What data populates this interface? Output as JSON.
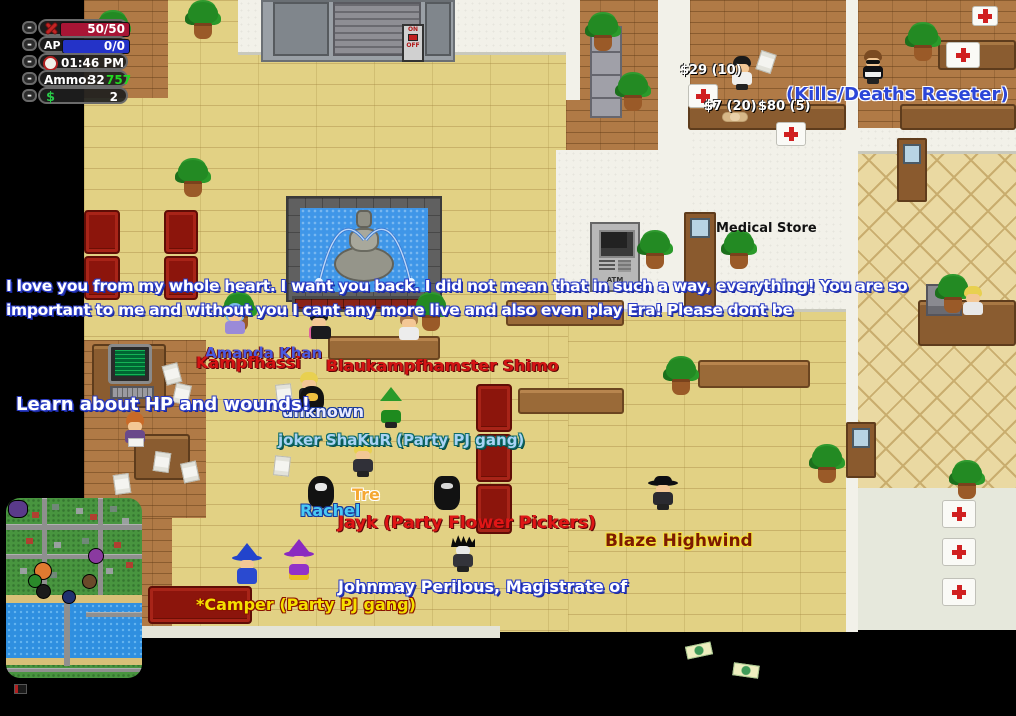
{
  "hud": {
    "minimize": "-",
    "health_value": "50/50",
    "ap_label": "AP",
    "ap_value": "0/0",
    "time": "01:46 PM",
    "ammo_label": "Ammo:",
    "ammo_value": "32",
    "ammo_extra": "757",
    "money_symbol": "$",
    "money_value": "2",
    "colors": {
      "health_bar": "#a81535",
      "ap_bar": "#2433c8",
      "ammo_extra": "#22d822",
      "money": "#28c848"
    }
  },
  "chat": {
    "line1": "I love you from my whole heart. I want you back. I did not mean that in such a way, everything! You are so",
    "line2": "important to me and without you I cant any more live and also even play Era! Please dont be",
    "hint": "Learn about HP and wounds!"
  },
  "world": {
    "medical_sign": "Medical Store",
    "npc_title": "(Kills/Deaths Reseter)",
    "npc_title_color": "#2c46d8",
    "price_medkit_small": "$29 (10)",
    "price_bandage": "$7 (20)",
    "price_medkit_large": "$80 (5)",
    "atm_label": "ATM",
    "switch_on": "ON",
    "switch_off": "OFF"
  },
  "players": [
    {
      "name": "Amanda Khan",
      "color": "#4a5ae0"
    },
    {
      "name": "Kampfhassi",
      "color": "#d41414"
    },
    {
      "name": "Blaukampfhamster Shimo",
      "color": "#d41414"
    },
    {
      "name": "unknown",
      "color": "#e8eaff"
    },
    {
      "name": "joker ShaKuR (Party PJ gang)",
      "color": "#a9d3f5"
    },
    {
      "name": "Tre",
      "color": "#f5a833"
    },
    {
      "name": "Rachel",
      "color": "#49c9f5"
    },
    {
      "name": "Jayk (Party Flower Pickers)",
      "color": "#e01616"
    },
    {
      "name": "Blaze Highwind",
      "color": "#7c1a02"
    },
    {
      "name": "Johnmay Perilous, Magistrate of",
      "color": "#ffffff"
    },
    {
      "name": "*Camper (Party PJ gang)",
      "color": "#f5e000"
    }
  ]
}
